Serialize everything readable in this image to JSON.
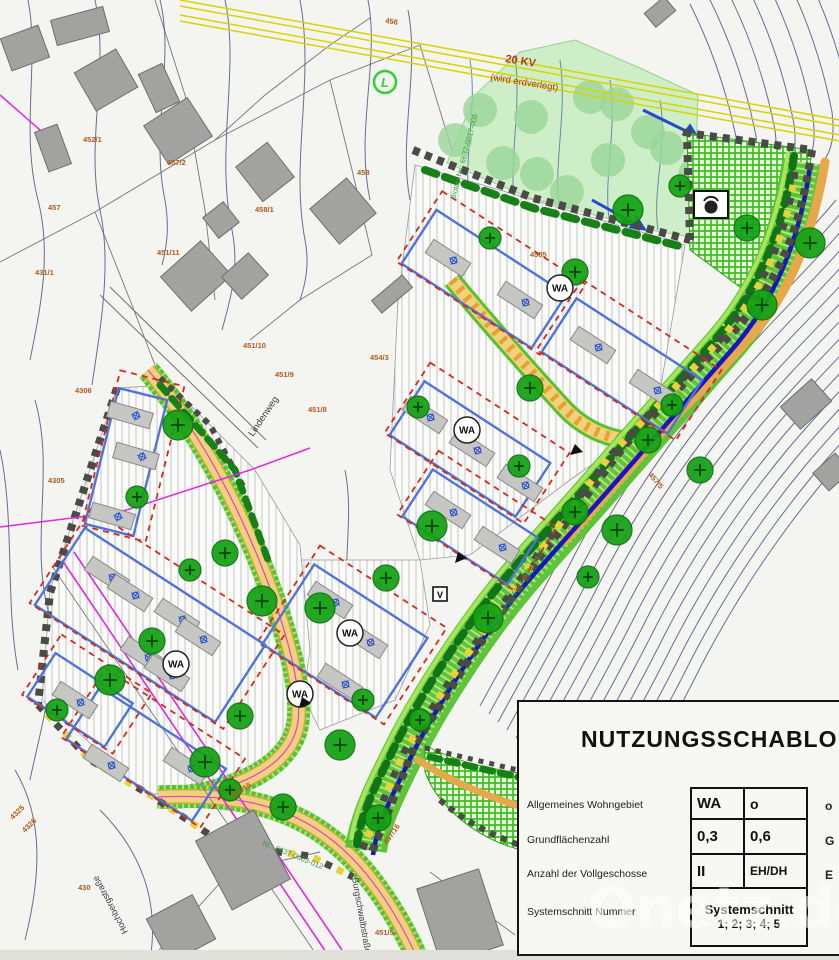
{
  "watermark": "Onetz.de",
  "legend": {
    "title": "NUTZUNGSSCHABLONE",
    "rows": [
      {
        "label": "Allgemeines Wohngebiet",
        "c1": "WA",
        "c2": "o"
      },
      {
        "label": "Grundflächenzahl",
        "c1": "0,3",
        "c2": "0,6"
      },
      {
        "label": "Anzahl der Vollgeschosse",
        "c1": "II",
        "c2": "EH/DH"
      },
      {
        "label": "Systemschnitt Nummer",
        "c1": "Systemschnitt",
        "c2": "1; 2; 3; 4; 5"
      }
    ],
    "right_fragments": [
      "o",
      "G",
      "E"
    ]
  },
  "map": {
    "power_line": {
      "line1": "20 KV",
      "line2": "(wird erdverlegt)"
    },
    "zone": "WA",
    "symbols": {
      "l": "L",
      "v": "V"
    },
    "biotop": {
      "top": "Biotop-Nr.: 6637-0017-005",
      "right": "Biotop-Nr.: 6637-0003-010",
      "bottom": "Nr.: 6637-0003-012"
    },
    "streets": {
      "lindenweg": "Lindenweg",
      "hochberg": "Hochbergstraße",
      "burgschwalb": "Burgschwalbstraße"
    },
    "parcels": [
      "457",
      "452/1",
      "457/2",
      "458/1",
      "451/11",
      "431/1",
      "458",
      "456",
      "451/10",
      "451/9",
      "451/8",
      "454/3",
      "4306",
      "4305",
      "4585",
      "451/15",
      "457/16",
      "451/5",
      "4325",
      "4326",
      "430",
      "457/5",
      "4520"
    ]
  },
  "colors": {
    "meadow": "#cdeec6",
    "bright_green": "#3dbe20",
    "road_yellow": "#f1d27c",
    "tree": "#14a214",
    "stream_blue": "#1717c0",
    "magenta": "#e02ae0",
    "power_yellow": "#d8d400",
    "parcel_label": "#b05a1e",
    "plot_blue": "#4f74d8",
    "boundary_red": "#d42a1e",
    "contour": "#4d577e"
  }
}
